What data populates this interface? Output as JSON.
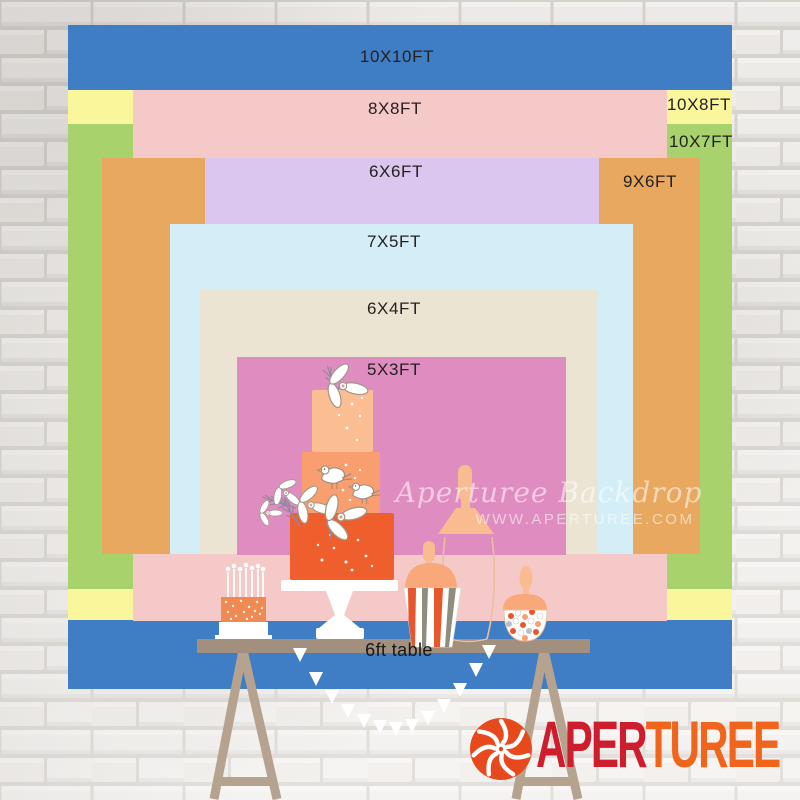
{
  "page": {
    "title": "Aperturee backdrop size comparison chart"
  },
  "sizes": [
    {
      "label": "10X10FT",
      "color": "#3f7ec5"
    },
    {
      "label": "10X8FT",
      "color": "#faf69b"
    },
    {
      "label": "10X7FT",
      "color": "#a7d26c"
    },
    {
      "label": "8X8FT",
      "color": "#f4c9c8"
    },
    {
      "label": "9X6FT",
      "color": "#e9a85f"
    },
    {
      "label": "6X6FT",
      "color": "#dbc6f0"
    },
    {
      "label": "7X5FT",
      "color": "#d3eef7"
    },
    {
      "label": "6X4FT",
      "color": "#ece4d2"
    },
    {
      "label": "5X3FT",
      "color": "#df8dc0"
    }
  ],
  "table": {
    "label": "6ft table",
    "board_color": "#a28f7e",
    "leg_color": "#b5a28f"
  },
  "watermark": {
    "line1": "Aperturee Backdrop",
    "line2": "WWW.APERTUREE.COM"
  },
  "logo": {
    "text_red": "APER",
    "text_orange": "TUREE",
    "red": "#ce1e2e",
    "orange": "#f0641c",
    "icon": "aperture-shutter-icon",
    "icon_color": "#e8491c"
  },
  "illustration": {
    "cake_tier_top": "#fbbe93",
    "cake_tier_mid": "#f99e6e",
    "cake_tier_bottom": "#ef5e2d",
    "accent_peach": "#f9bb90",
    "lid_peach": "#f8a879",
    "accent_orange": "#e8572b",
    "stripe_gray": "#8f8d7e"
  }
}
